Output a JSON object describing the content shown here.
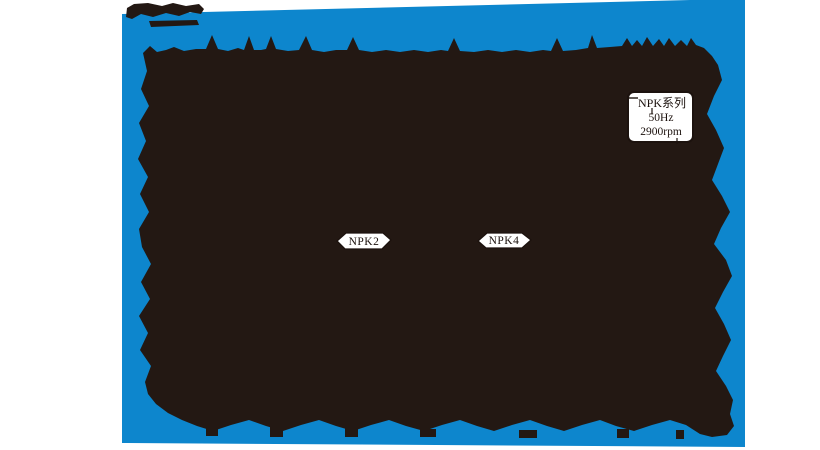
{
  "colors": {
    "frame_blue": "#0d86cd",
    "ink_black": "#231813",
    "paper_white": "#ffffff",
    "text_black": "#1c120e"
  },
  "callout": {
    "series_family": "NPK系列",
    "frequency": "50Hz",
    "speed": "2900rpm"
  },
  "curve_labels": {
    "npk2": "NPK2",
    "npk4": "NPK4"
  },
  "chart_data": {
    "type": "line",
    "title": "NPK系列 50Hz 2900rpm",
    "series": [
      {
        "name": "NPK2",
        "values": []
      },
      {
        "name": "NPK4",
        "values": []
      }
    ],
    "legend_position": "floating callout, upper right",
    "note": "Scanned pump performance-curve page. The plot area is fully saturated with black ink: axes, tick numbers, gridlines and curve values are illegible. Only the callout box (NPK系列 / 50Hz / 2900rpm) and the curve tags NPK2 / NPK4 remain visible, plus jagged remnants of axis numerals along the blue border."
  }
}
